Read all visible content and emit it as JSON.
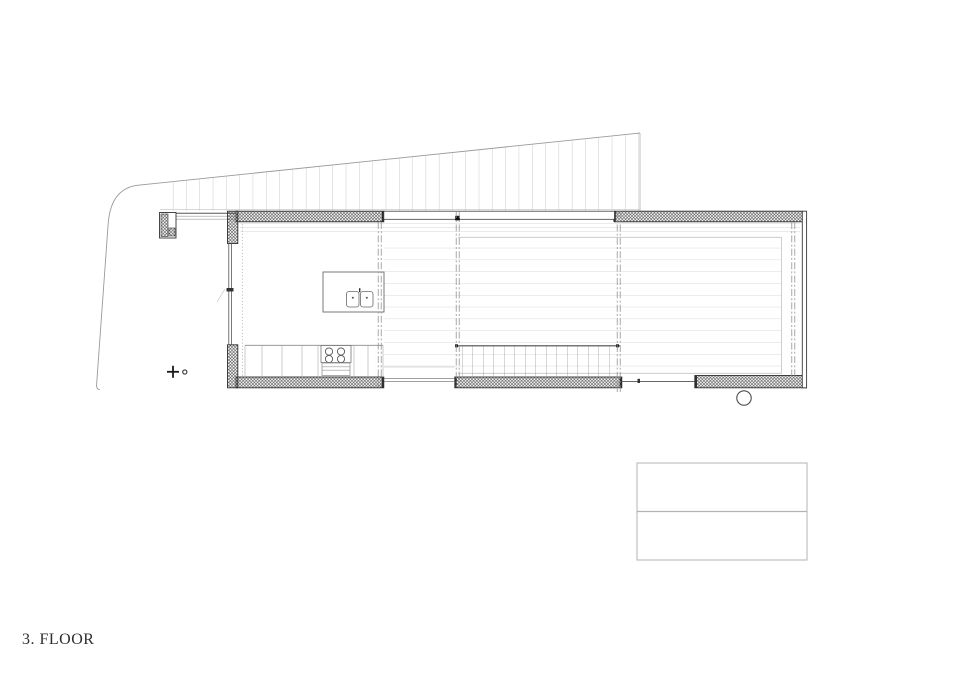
{
  "label": {
    "text": "3. FLOOR"
  },
  "title_block": {
    "rows": [
      "",
      ""
    ],
    "note": "empty two-row title block"
  },
  "drawing": {
    "kind": "architectural-floor-plan",
    "floor_number": "3",
    "features": [
      "sloped-roof-hatch",
      "site-boundary-line",
      "exterior-hatched-walls",
      "glazed-openings",
      "kitchen-island-with-double-sink",
      "cooktop-four-burners",
      "base-cabinets",
      "deck-plank-lines",
      "stair-treads",
      "section-lines",
      "column-circle",
      "level-marker-cross"
    ]
  },
  "colors": {
    "ink": "#2e2e2e",
    "wall_hatch": "#404040",
    "faint_line": "#cfcfcf",
    "roof_line": "#b5b5b5",
    "background": "#ffffff"
  }
}
